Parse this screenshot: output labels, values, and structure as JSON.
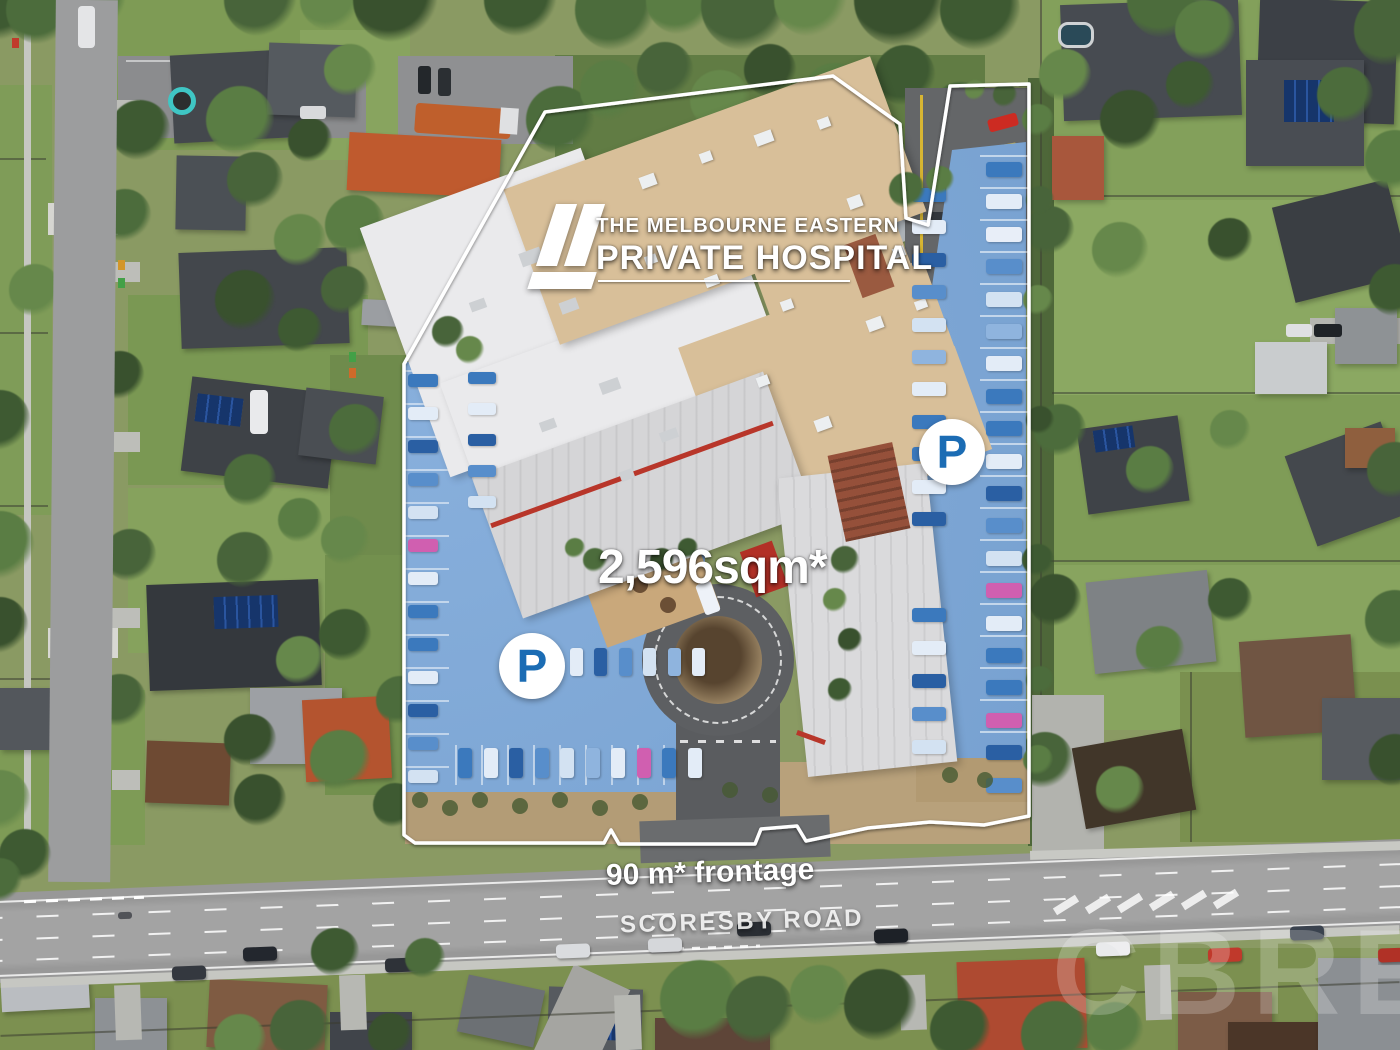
{
  "branding": {
    "logo_line1": "THE MELBOURNE EASTERN",
    "logo_line2": "PRIVATE HOSPITAL"
  },
  "annotations": {
    "area": "2,596sqm*",
    "frontage": "90 m* frontage",
    "road_name": "SCORESBY ROAD",
    "parking_symbol": "P"
  },
  "watermark": {
    "text": "CBRE"
  },
  "colors": {
    "boundary": "#ffffff",
    "parking_overlay": "#74a2d6",
    "parking_letter": "#1b6cb4",
    "tan_roof": "#d8bf99",
    "white_roof": "#eaeaec",
    "road": "#a3a3a3",
    "grass": "#8a9a63"
  }
}
